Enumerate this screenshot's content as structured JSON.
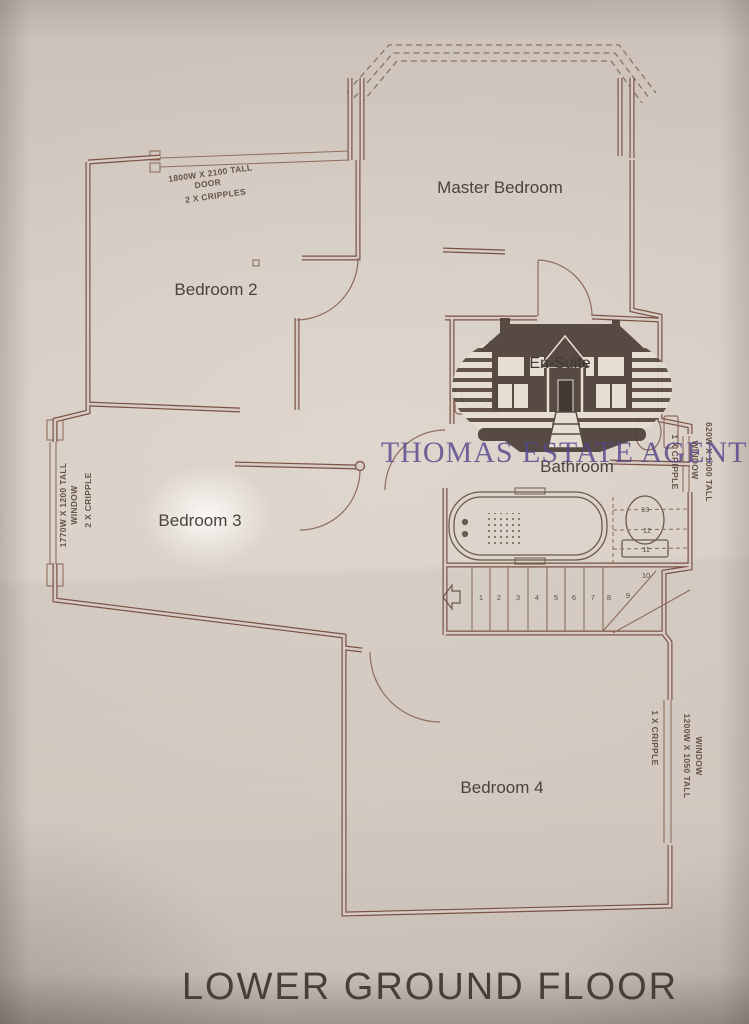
{
  "title": "LOWER GROUND FLOOR",
  "watermark": {
    "text": "THOMAS ESTATE AGENTS"
  },
  "rooms": {
    "master_bedroom": "Master Bedroom",
    "bedroom2": "Bedroom 2",
    "bedroom3": "Bedroom 3",
    "bedroom4": "Bedroom 4",
    "bathroom": "Bathroom",
    "ensuite": "En-Suite"
  },
  "annotations": {
    "top_door": {
      "dim": "1800W X 2100 TALL",
      "type": "DOOR",
      "cripples": "2 X CRIPPLES"
    },
    "left_window": {
      "dim": "1770W X 1200 TALL",
      "type": "WINDOW",
      "cripples": "2 X CRIPPLE"
    },
    "ensuite_window": {
      "cripples": "1 X CRIPPLE",
      "type": "WINDOW",
      "dim": "620W X 1000 TALL"
    },
    "bedroom4_window": {
      "cripples": "1 X CRIPPLE",
      "dim": "1200W X 1050 TALL",
      "type": "WINDOW"
    }
  },
  "stairs": {
    "steps": [
      "1",
      "2",
      "3",
      "4",
      "5",
      "6",
      "7",
      "8",
      "9",
      "10",
      "11",
      "12",
      "13"
    ]
  },
  "colors": {
    "wall": "#7b5144",
    "thin_line": "#90705f",
    "label_text": "#4a443c",
    "watermark_purple": "#56478c",
    "logo_sepia": "#4d4038",
    "paper": "#d2c8bf"
  }
}
